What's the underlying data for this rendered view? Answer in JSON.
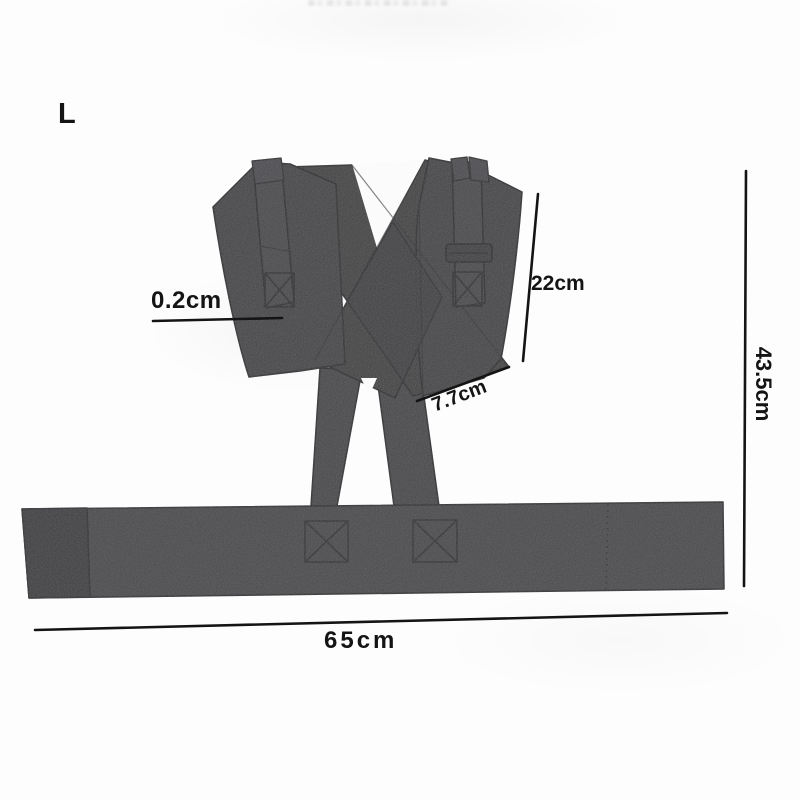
{
  "size_label": "L",
  "dimensions": {
    "strap_thickness": "0.2cm",
    "back_height": "22cm",
    "strap_bottom_width": "7.7cm",
    "total_height": "43.5cm",
    "belt_length": "65cm"
  },
  "colors": {
    "background": "#fdfdfd",
    "fabric": "#424244",
    "fabric_dark": "#3a3a3c",
    "fabric_light": "#4a4a4c",
    "stitch": "#2a2a2c",
    "annotation": "#141414"
  }
}
